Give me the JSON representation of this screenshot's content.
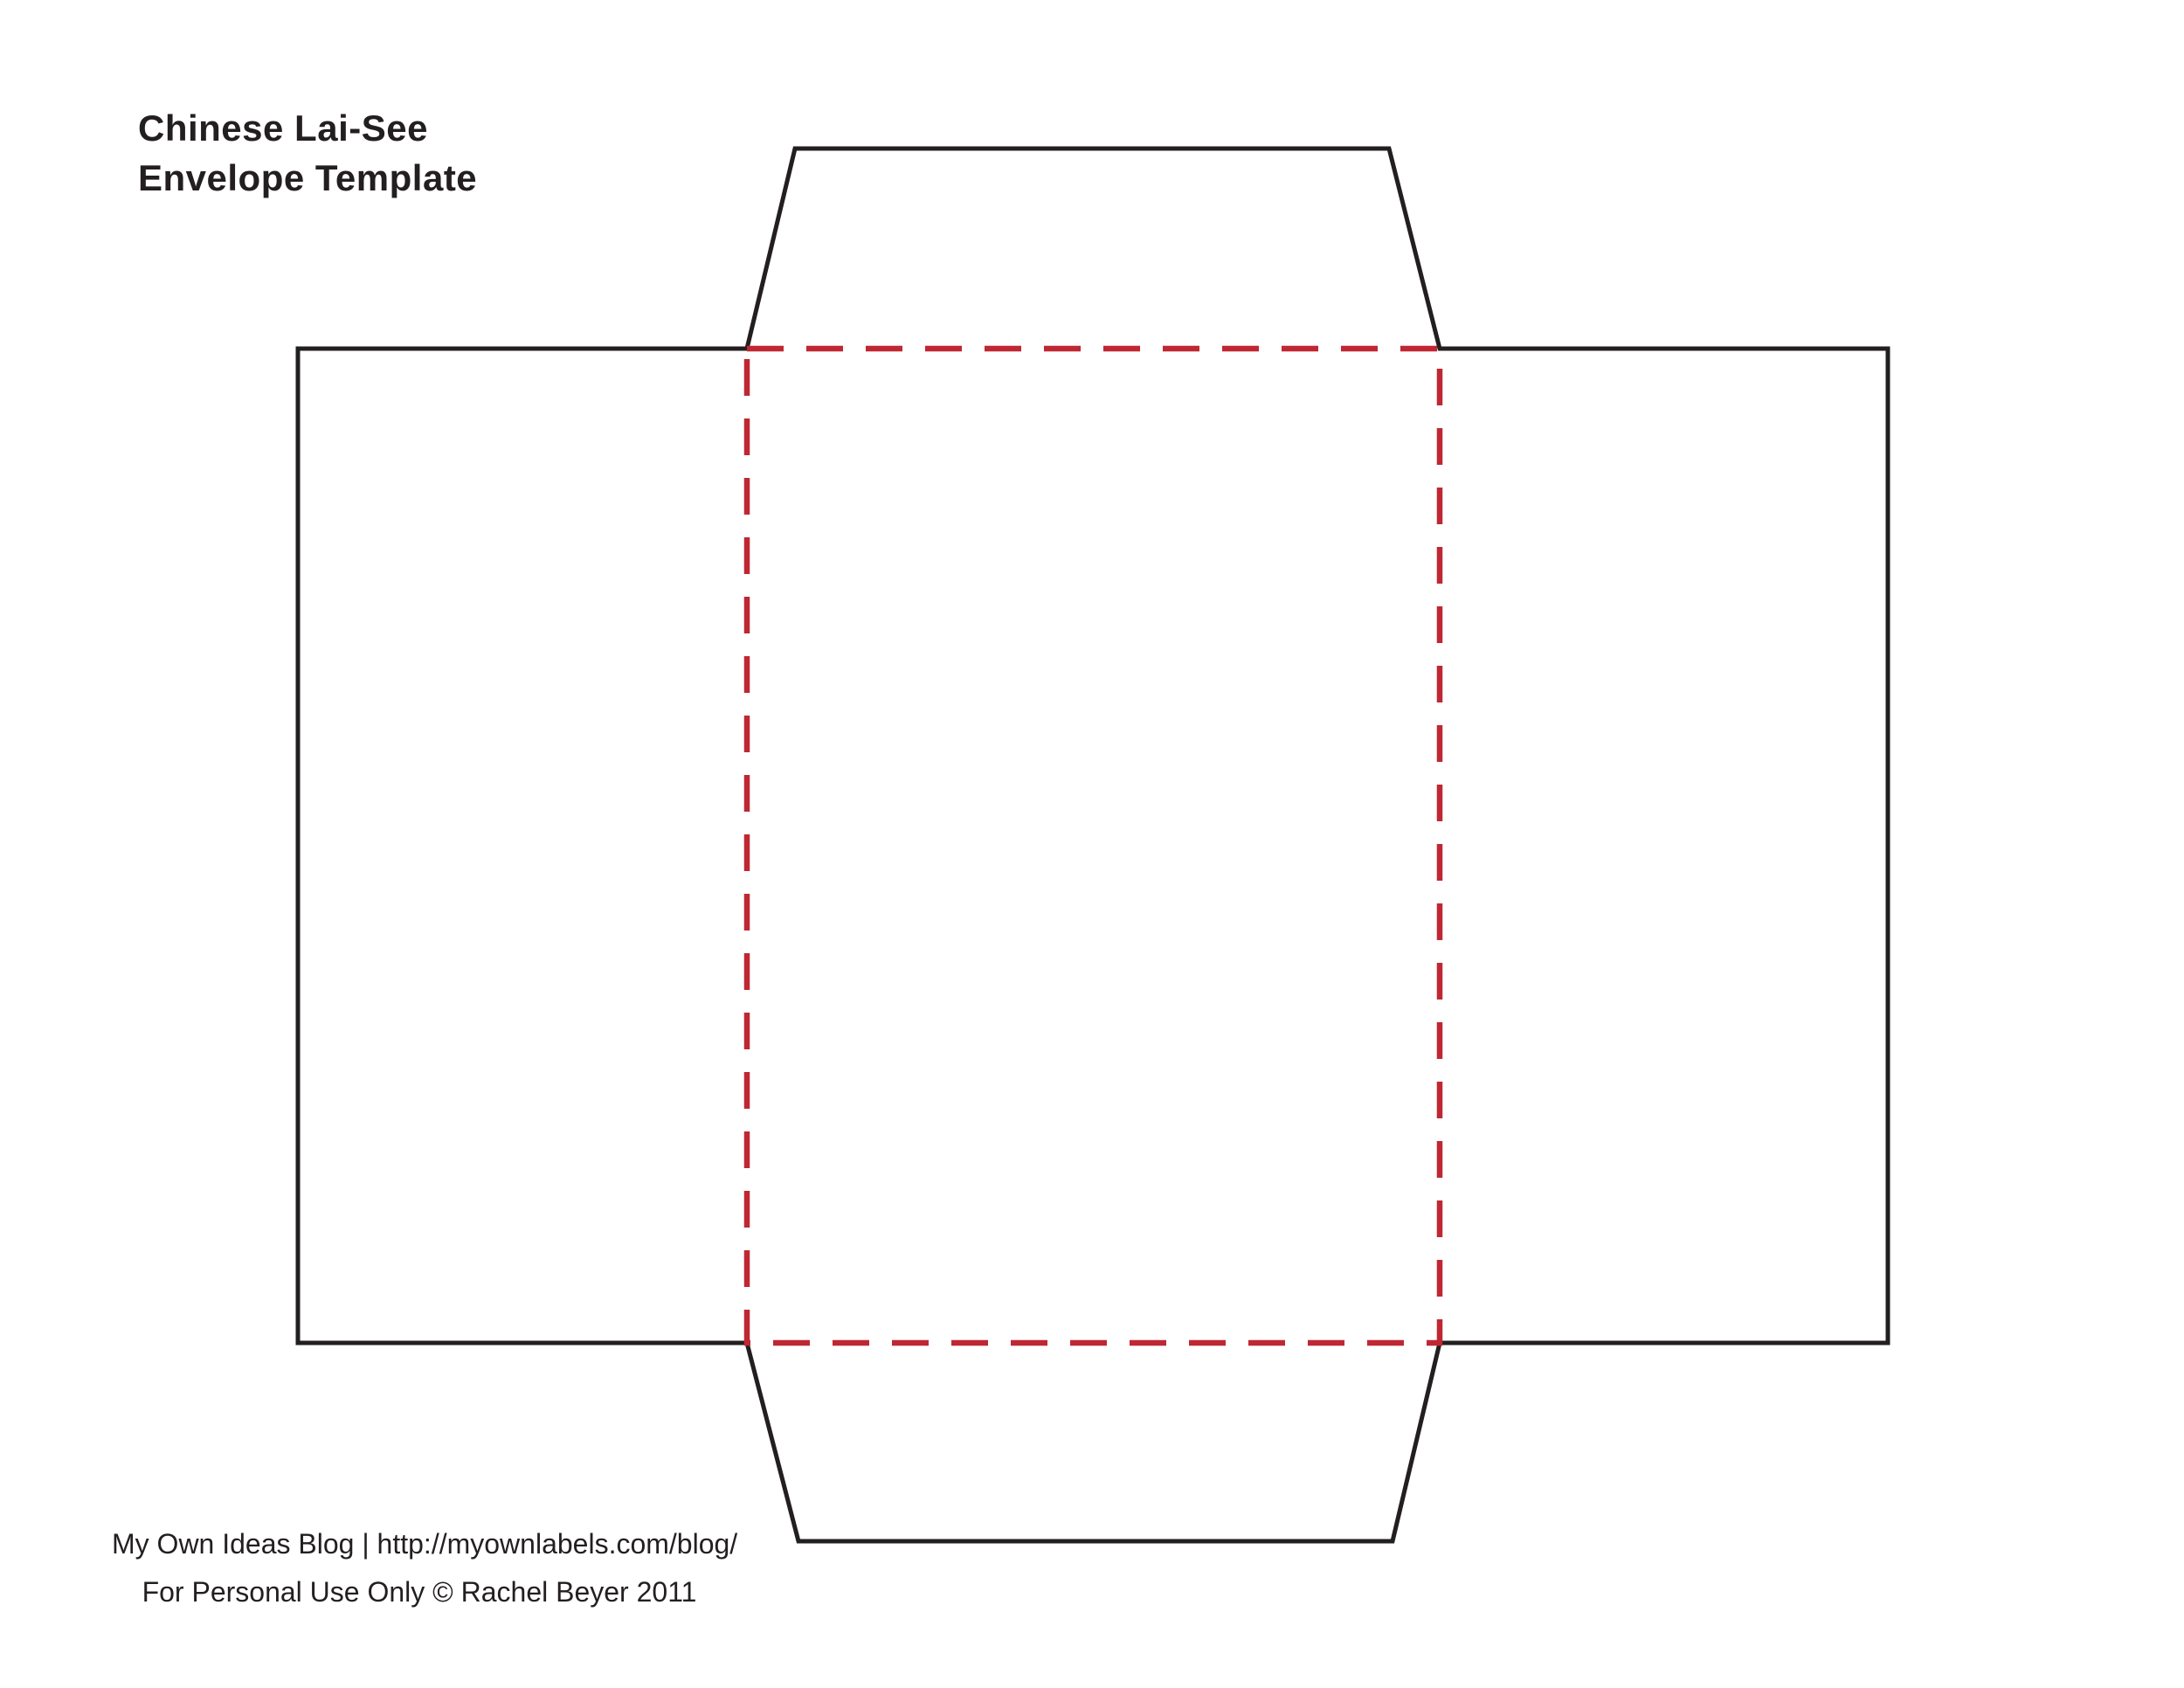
{
  "document": {
    "title": {
      "line1": "Chinese Lai-See",
      "line2": "Envelope Template"
    },
    "footer": {
      "line1": "My Own Ideas Blog | http://myownlabels.com/blog/",
      "line2": "For Personal Use Only © Rachel Beyer 2011"
    },
    "colors": {
      "background": "#ffffff",
      "text": "#231f20",
      "cut_line": "#231f20",
      "fold_line": "#bf2733"
    }
  }
}
